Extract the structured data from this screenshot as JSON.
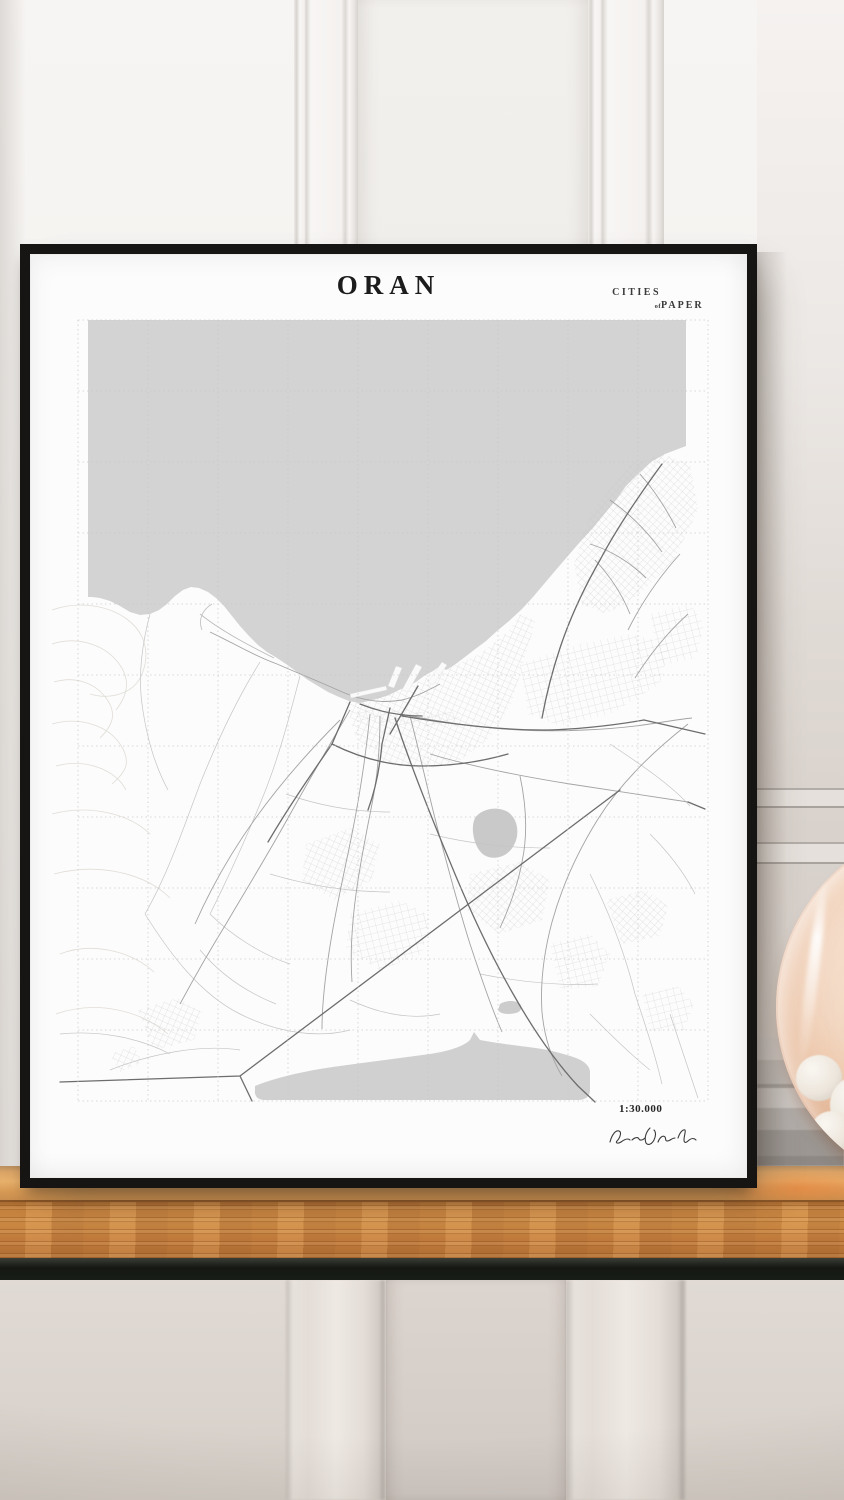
{
  "poster": {
    "title": "ORAN",
    "brand": {
      "line1": "CITIES",
      "of": "of",
      "line2": "PAPER"
    },
    "scale_label": "1:30.000",
    "signature_text": "Ron Botha"
  },
  "map": {
    "city": "Oran",
    "style": "minimalist black-and-white street map with dashed graticule grid, gray sea and salt lake"
  },
  "colors": {
    "sea_gray": "#d3d3d3",
    "frame_black": "#171513",
    "poster_white": "#fcfcfc",
    "shelf_wood": "#cd8a45",
    "shelf_shadow": "#141712",
    "upper_wall": "#f5f3f1",
    "lower_wall": "#ddd6d0",
    "sphere_copper": "#e09a6c"
  }
}
